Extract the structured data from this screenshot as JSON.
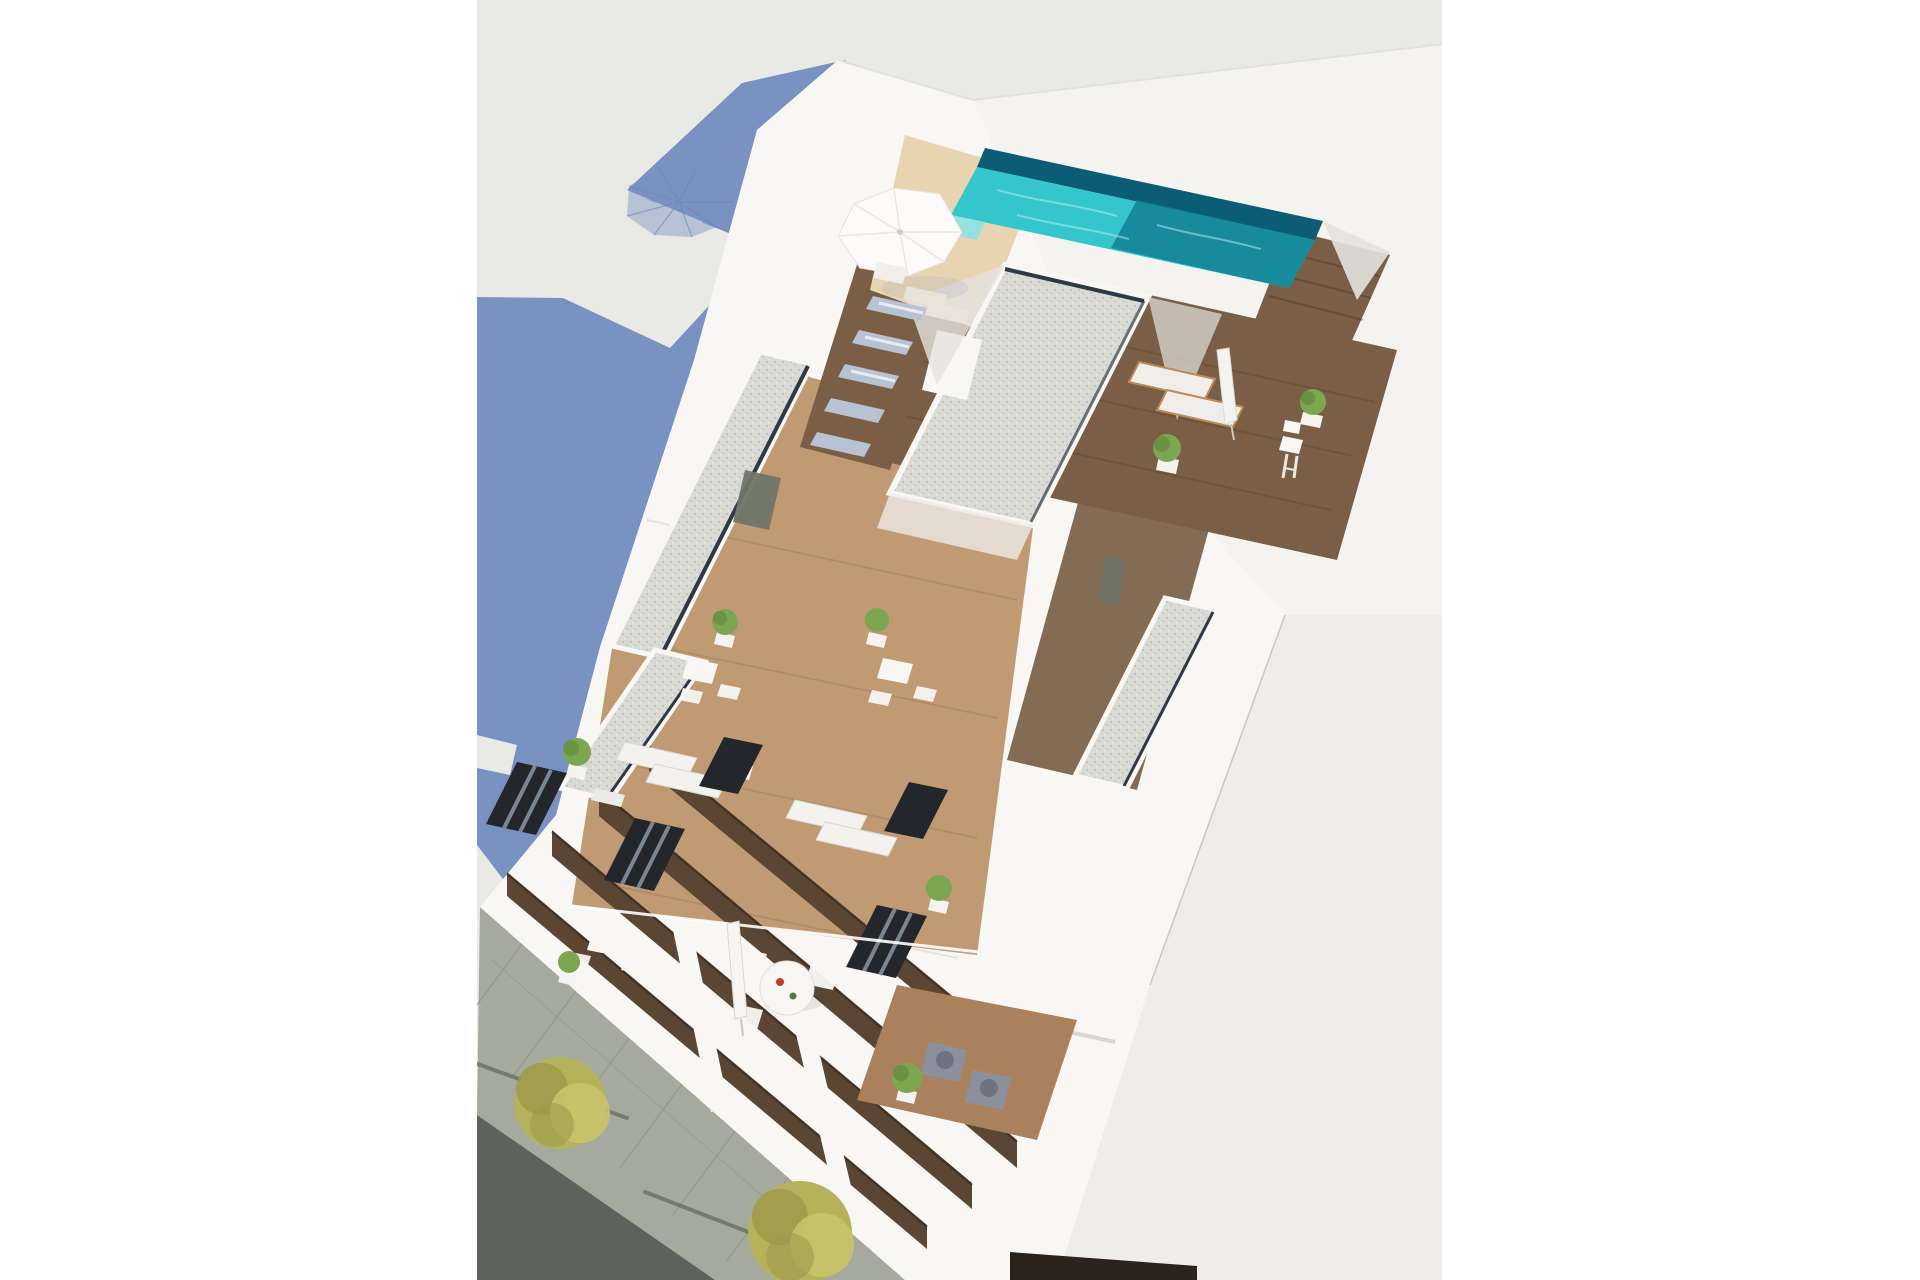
{
  "scene": {
    "type": "architectural_3d_render",
    "view": "aerial_top_down",
    "subject": "Aerial 3D render of a modern white apartment building with rooftop swimming pool, sun terraces, balconies and street below",
    "time_of_day": "sunny midday with long blue building shadow",
    "elements": {
      "building_shadow": 1,
      "umbrella_shadow": 1,
      "rooftop_pool": 1,
      "pool_parasol_open": 1,
      "parasol_folded": 2,
      "rooftop_loungers_blue": 5,
      "wooden_loungers": 2,
      "terrace_lounger_pairs": 2,
      "bistro_table_sets": 3,
      "round_dining_table": 1,
      "dining_chairs": 4,
      "gray_armchairs": 2,
      "potted_plants": 8,
      "gravel_roof_decks": 4,
      "wood_floor_terraces": 6,
      "dark_glass_doors": 6,
      "balcony_slab_levels": 4,
      "street_trees": 2,
      "sidewalk": 1,
      "asphalt_road": 1
    }
  },
  "media": {
    "canvas_width": 1920,
    "canvas_height": 1280,
    "content_box": {
      "x": 477,
      "y": 0,
      "width": 965,
      "height": 1280
    }
  },
  "palette": {
    "bg_page": "#ffffff",
    "bg_photo": "#e9e9e6",
    "shadow_blue": "#7a92c2",
    "shadow_rib": "#6d86b8",
    "building": "#f8f7f4",
    "building_tone1": "#f4f3ef",
    "building_tone2": "#efede8",
    "wall_shade": "#e3e2de",
    "wall_dark_line": "#2e3947",
    "gravel": "#dadad5",
    "gravel_dot": "#bcbbb6",
    "pool": "#35c6cd",
    "pool_deep": "#127f93",
    "pool_shadow": "#0b5c74",
    "pool_step": "#8ce2e4",
    "pool_ripple": "#bdf0ef",
    "sand": "#e8d4b0",
    "wood_dark": "#7a5e45",
    "wood_mid": "#a9815c",
    "wood_light": "#c09a73",
    "lounger_blue": "#b7c2d3",
    "lounger_stripe": "#e8ecf2",
    "lounger_white": "#f3f2ee",
    "lounger_frame": "#b98c58",
    "cushion": "#f0eee8",
    "plant": "#7da650",
    "plant_dark": "#5d8638",
    "pot": "#f4f3f0",
    "table_white": "#f7f6f3",
    "chair_gray": "#8b919c",
    "chair_gray_dark": "#6e747f",
    "door_dark": "#23262b",
    "curtain": "#8a97a3",
    "door_green": "#6f7566",
    "sidewalk": "#a6a99d",
    "asphalt": "#5d625c",
    "paving_line": "#8e9186",
    "tree": "#b5b25c",
    "tree_dark": "#9c9a4b",
    "tree_light": "#c6c36c",
    "trunk_shadow": "#4f544d",
    "void_brown": "#5a4633",
    "void_dark": "#2f261c",
    "storefront": "#2a241d",
    "accent_red": "#c0392b",
    "accent_green": "#4e7d3a",
    "edge_line": "#e2e1dd",
    "seam": "#c9c7c2",
    "slab_line": "#d8d6d2"
  }
}
